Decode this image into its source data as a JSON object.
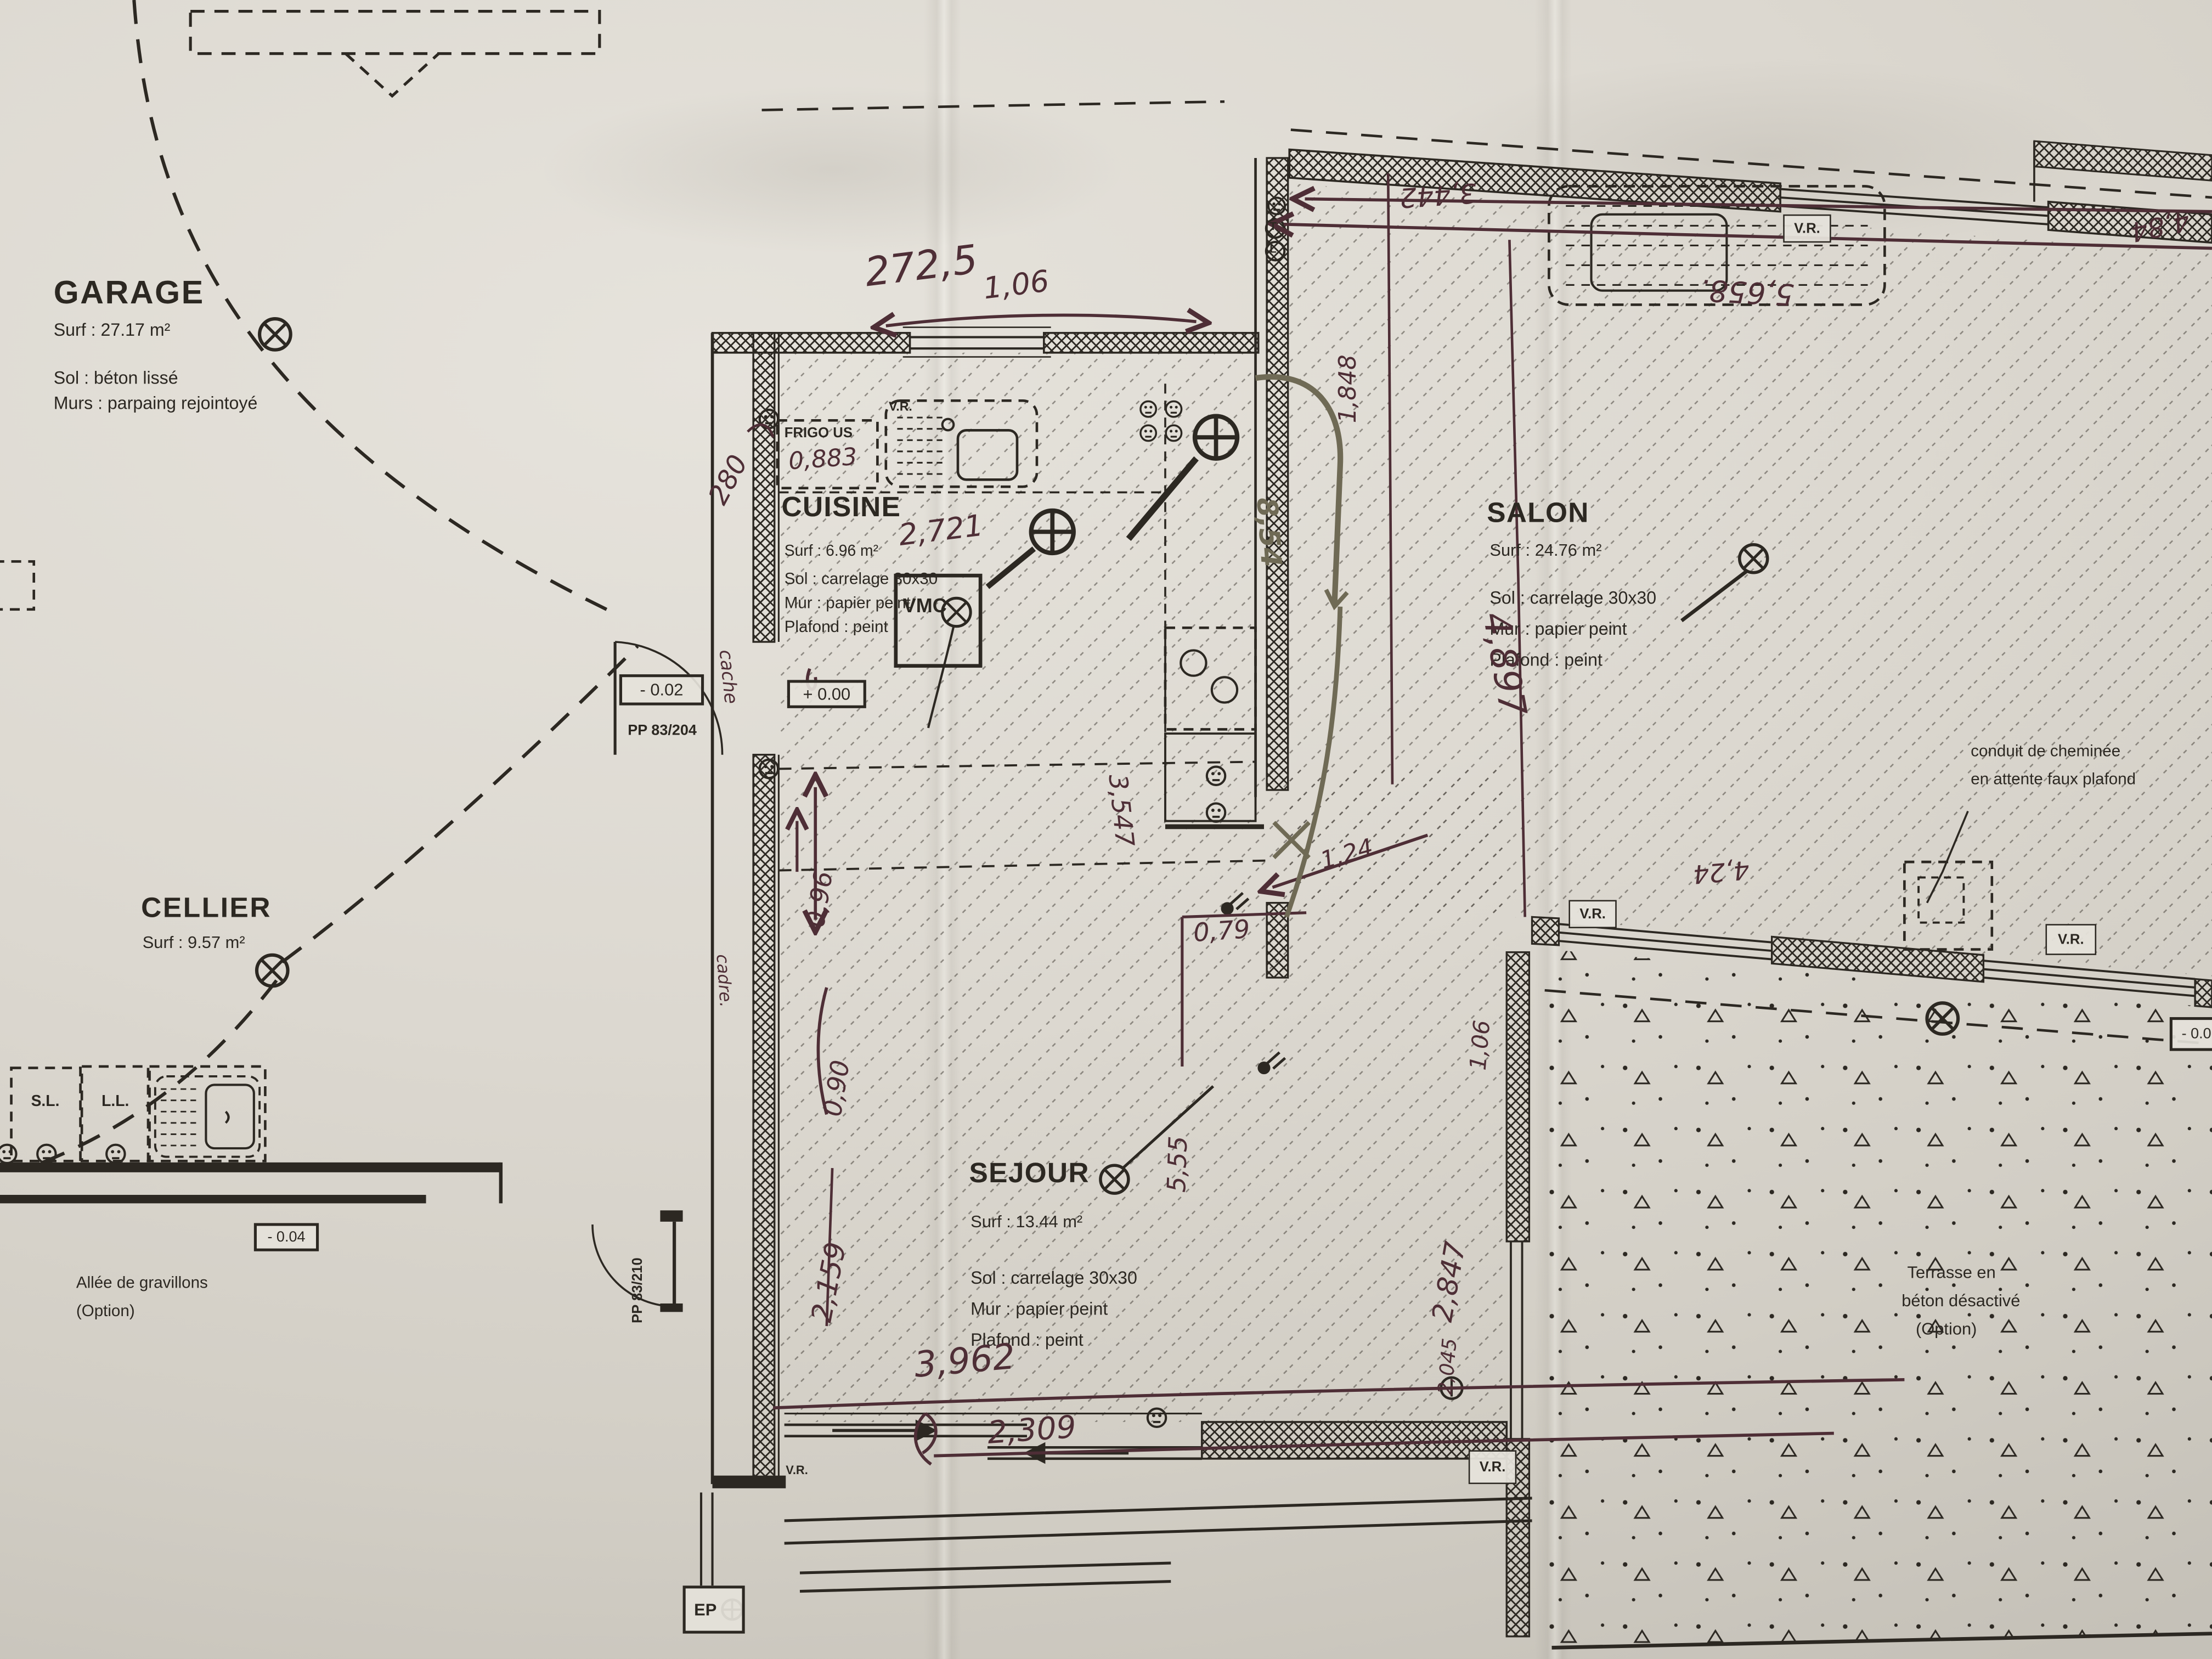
{
  "rooms": {
    "garage": {
      "name": "GARAGE",
      "surface": "Surf : 27.17 m²",
      "sol": "Sol : béton lissé",
      "murs": "Murs : parpaing rejointoyé"
    },
    "cellier": {
      "name": "CELLIER",
      "surface": "Surf : 9.57 m²"
    },
    "cuisine": {
      "name": "CUISINE",
      "surface": "Surf : 6.96 m²",
      "sol": "Sol : carrelage 30x30",
      "mur": "Mur : papier peint",
      "plafond": "Plafond : peint"
    },
    "salon": {
      "name": "SALON",
      "surface": "Surf : 24.76 m²",
      "sol": "Sol : carrelage 30x30",
      "mur": "Mur : papier peint",
      "plafond": "Plafond : peint"
    },
    "sejour": {
      "name": "SEJOUR",
      "surface": "Surf : 13.44 m²",
      "sol": "Sol : carrelage 30x30",
      "mur": "Mur : papier peint",
      "plafond": "Plafond : peint"
    },
    "terrasse": {
      "l1": "Terrasse en",
      "l2": "béton désactivé",
      "l3": "(Option)"
    },
    "allee": {
      "l1": "Allée de gravillons",
      "l2": "(Option)"
    }
  },
  "labels": {
    "frigo": "FRIGO US",
    "vmc": "VMC",
    "vr": "V.R.",
    "sl": "S.L.",
    "ll": "L.L.",
    "ep": "EP",
    "pp204": "PP 83/204",
    "pp210": "PP 83/210",
    "m002": "- 0.02",
    "p000": "+ 0.00",
    "m004": "- 0.04",
    "m00": "- 0.0",
    "conduit1": "conduit de cheminée",
    "conduit2": "en attente faux plafond",
    "t": "T",
    "l": "L"
  },
  "hand": {
    "w2725": "272,5",
    "w106": "1,06",
    "frigo": "0,883",
    "cuisine_w": "2,721",
    "d280": "280",
    "cache": "cache",
    "cadre": "cadre.",
    "w096": "0,96",
    "w090": "0,90",
    "d2159": "2,159",
    "d3962": "3,962",
    "d2309": "2,309",
    "d555": "5,55",
    "d079": "0,79",
    "d124": "1,24",
    "d2847": "2,847",
    "d854": "8,54",
    "d3547": "3,547",
    "d1848": "1,848",
    "d3442": "3,442",
    "d5658": "5,658.",
    "d484": "4,84",
    "d424": "4,24",
    "d4897": "4,897",
    "v106": "1,06",
    "d2045": "2,045"
  },
  "colors": {
    "paper": "#d8d4cc",
    "ink": "#2c2822",
    "pen": "#4e2e36",
    "marker": "#6f6a55"
  }
}
